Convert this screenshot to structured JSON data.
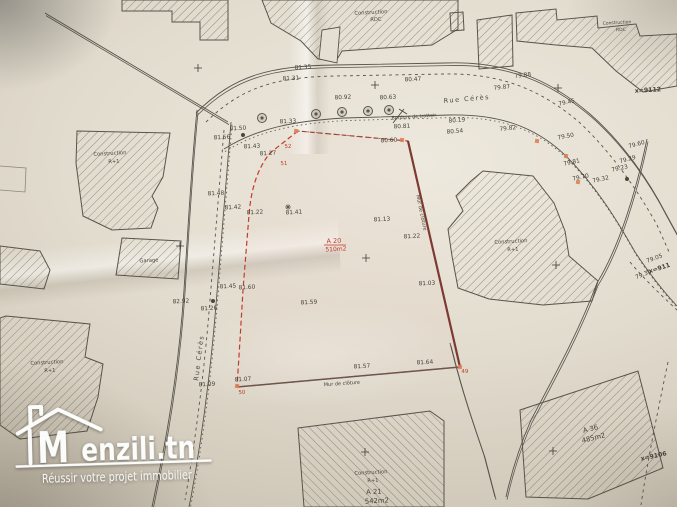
{
  "logo": {
    "m": "M",
    "brand": "enzili.tn",
    "tagline": "Réussir votre projet immobilier"
  },
  "plan": {
    "parcel": {
      "id": "A 20",
      "area": "510m2",
      "corner_points": [
        "49",
        "50",
        "51",
        "52"
      ]
    },
    "colors": {
      "ink": "#45423a",
      "street_name": "#4a473f",
      "red": "#c23b2c",
      "wall_right": "#7c3a33",
      "wall_bottom": "#6e564c",
      "marker": "#dd7f58",
      "hatch": "#6e6a5e",
      "line": "#57544b",
      "logo": "#ffffff"
    },
    "labels": [
      {
        "x": 303,
        "y": 69,
        "t": "81.35",
        "k": "e"
      },
      {
        "x": 291,
        "y": 80,
        "t": "81.31",
        "k": "e"
      },
      {
        "x": 413,
        "y": 81,
        "t": "80.47",
        "k": "e"
      },
      {
        "x": 343,
        "y": 99,
        "t": "80.92",
        "k": "e"
      },
      {
        "x": 388,
        "y": 99,
        "t": "80.63",
        "k": "e"
      },
      {
        "x": 523,
        "y": 77,
        "t": "79.88",
        "k": "e",
        "r": -6
      },
      {
        "x": 502,
        "y": 89,
        "t": "79.87",
        "k": "e",
        "r": -6
      },
      {
        "x": 567,
        "y": 104,
        "t": "79.45",
        "k": "e",
        "r": -12
      },
      {
        "x": 457,
        "y": 122,
        "t": "80.19",
        "k": "e",
        "r": -4
      },
      {
        "x": 414,
        "y": 118,
        "t": "Bordure de trottoir",
        "k": "n",
        "s": 4.8,
        "r": -4
      },
      {
        "x": 455,
        "y": 133,
        "t": "80.54",
        "k": "e",
        "r": -4
      },
      {
        "x": 508,
        "y": 130,
        "t": "79.82",
        "k": "e",
        "r": -6
      },
      {
        "x": 566,
        "y": 138,
        "t": "79.50",
        "k": "e",
        "r": -10
      },
      {
        "x": 637,
        "y": 146,
        "t": "79.60",
        "k": "e",
        "r": -15
      },
      {
        "x": 628,
        "y": 161,
        "t": "79.29",
        "k": "e",
        "r": -15
      },
      {
        "x": 620,
        "y": 170,
        "t": "79.23",
        "k": "e",
        "r": -12
      },
      {
        "x": 572,
        "y": 164,
        "t": "79.81",
        "k": "e",
        "r": -12
      },
      {
        "x": 581,
        "y": 179,
        "t": "79.70",
        "k": "e",
        "r": -12
      },
      {
        "x": 601,
        "y": 181,
        "t": "79.32",
        "k": "e",
        "r": -12
      },
      {
        "x": 648,
        "y": 92,
        "t": "x=9112",
        "k": "c"
      },
      {
        "x": 655,
        "y": 260,
        "t": "79.05",
        "k": "e",
        "r": -20
      },
      {
        "x": 660,
        "y": 270,
        "t": "x=911",
        "k": "c",
        "r": -18
      },
      {
        "x": 644,
        "y": 276,
        "t": "79.30",
        "k": "e",
        "r": -22
      },
      {
        "x": 288,
        "y": 123,
        "t": "81.33",
        "k": "e"
      },
      {
        "x": 238,
        "y": 130,
        "t": "81.50",
        "k": "e"
      },
      {
        "x": 222,
        "y": 139,
        "t": "81.56",
        "k": "e"
      },
      {
        "x": 252,
        "y": 148,
        "t": "81.43",
        "k": "e"
      },
      {
        "x": 268,
        "y": 155,
        "t": "81.27",
        "k": "e"
      },
      {
        "x": 216,
        "y": 195,
        "t": "81.48",
        "k": "e"
      },
      {
        "x": 233,
        "y": 209,
        "t": "81.42",
        "k": "e"
      },
      {
        "x": 255,
        "y": 214,
        "t": "81.22",
        "k": "e"
      },
      {
        "x": 294,
        "y": 214,
        "t": "81.41",
        "k": "e"
      },
      {
        "x": 382,
        "y": 221,
        "t": "81.13",
        "k": "e"
      },
      {
        "x": 412,
        "y": 238,
        "t": "81.22",
        "k": "e"
      },
      {
        "x": 427,
        "y": 285,
        "t": "81.03",
        "k": "e"
      },
      {
        "x": 228,
        "y": 288,
        "t": "81.45",
        "k": "e"
      },
      {
        "x": 247,
        "y": 289,
        "t": "81.60",
        "k": "e"
      },
      {
        "x": 181,
        "y": 303,
        "t": "82.92",
        "k": "e"
      },
      {
        "x": 209,
        "y": 310,
        "t": "81.26",
        "k": "e"
      },
      {
        "x": 309,
        "y": 304,
        "t": "81.59",
        "k": "e"
      },
      {
        "x": 362,
        "y": 368,
        "t": "81.57",
        "k": "e"
      },
      {
        "x": 425,
        "y": 364,
        "t": "81.64",
        "k": "e"
      },
      {
        "x": 207,
        "y": 386,
        "t": "81.09",
        "k": "e"
      },
      {
        "x": 243,
        "y": 381,
        "t": "81.07",
        "k": "e"
      },
      {
        "x": 389,
        "y": 142,
        "t": "80.60",
        "k": "e"
      },
      {
        "x": 402,
        "y": 128,
        "t": "80.81",
        "k": "e"
      },
      {
        "x": 342,
        "y": 385,
        "t": "Mur de clôture",
        "k": "n",
        "s": 5,
        "r": -4
      },
      {
        "x": 420,
        "y": 213,
        "t": "Mur de clôture",
        "k": "n",
        "s": 5,
        "r": 78
      },
      {
        "x": 467,
        "y": 101,
        "t": "Rue Cérès",
        "k": "s",
        "r": -5
      },
      {
        "x": 201,
        "y": 358,
        "t": "Rue Cérès",
        "k": "s",
        "r": -83
      },
      {
        "x": 371,
        "y": 14,
        "t": "Construction",
        "k": "n"
      },
      {
        "x": 376,
        "y": 21,
        "t": "RDC",
        "k": "n"
      },
      {
        "x": 617,
        "y": 24,
        "t": "Construction",
        "k": "n",
        "s": 4.5
      },
      {
        "x": 621,
        "y": 31,
        "t": "RDC",
        "k": "n",
        "s": 4.5
      },
      {
        "x": 110,
        "y": 155,
        "t": "Construction",
        "k": "n"
      },
      {
        "x": 114,
        "y": 163,
        "t": "R+1",
        "k": "n"
      },
      {
        "x": 149,
        "y": 262,
        "t": "Garage",
        "k": "n"
      },
      {
        "x": 47,
        "y": 364,
        "t": "Construction",
        "k": "n"
      },
      {
        "x": 50,
        "y": 372,
        "t": "R+1",
        "k": "n"
      },
      {
        "x": 511,
        "y": 243,
        "t": "Construction",
        "k": "n"
      },
      {
        "x": 513,
        "y": 251,
        "t": "R+1",
        "k": "n"
      },
      {
        "x": 371,
        "y": 474,
        "t": "Construction",
        "k": "n"
      },
      {
        "x": 373,
        "y": 482,
        "t": "R+1",
        "k": "n"
      },
      {
        "x": 374,
        "y": 494,
        "t": "A 21",
        "k": "a"
      },
      {
        "x": 377,
        "y": 503,
        "t": "542m2",
        "k": "a"
      },
      {
        "x": 591,
        "y": 431,
        "t": "A 36",
        "k": "a",
        "r": -14
      },
      {
        "x": 594,
        "y": 440,
        "t": "485m2",
        "k": "a",
        "r": -14
      },
      {
        "x": 654,
        "y": 458,
        "t": "x=9106",
        "k": "c",
        "r": -12
      }
    ],
    "red_labels": [
      {
        "x": 288,
        "y": 148,
        "t": "52"
      },
      {
        "x": 284,
        "y": 165,
        "t": "51"
      },
      {
        "x": 242,
        "y": 394,
        "t": "50"
      },
      {
        "x": 465,
        "y": 373,
        "t": "49"
      },
      {
        "x": 334,
        "y": 243,
        "t": "A 20",
        "s": 6.5
      },
      {
        "x": 336,
        "y": 251,
        "t": "510m2",
        "s": 6
      }
    ]
  }
}
